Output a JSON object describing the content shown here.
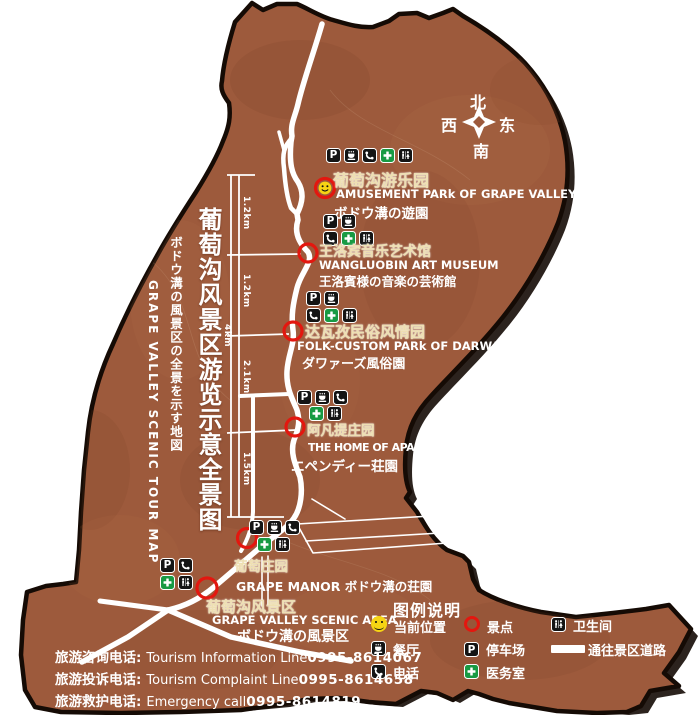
{
  "map_title": {
    "zh": "葡萄沟风景区游览示意全景图",
    "ja": "ボドウ溝の風景区の全景を示す地図",
    "en": "GRAPE  VALLEY  SCENIC  TOUR  MAP"
  },
  "compass": {
    "north": "北",
    "west": "西",
    "east": "东",
    "south": "南"
  },
  "scale": {
    "segments": [
      "1.2km",
      "1.2km",
      "2.1km",
      "1.5km"
    ],
    "total": "4km"
  },
  "icons": {
    "parking_label": "P"
  },
  "pois": [
    {
      "id": "amusement-park",
      "marker": "current-position",
      "icon_rows": [
        [
          "parking",
          "restaurant",
          "phone",
          "medical",
          "toilet"
        ]
      ],
      "zh": "葡萄沟游乐园",
      "en": "AMUSEMENT PARk OF GRAPE VALLEY",
      "ja": "ボドウ溝の遊園"
    },
    {
      "id": "wangluobin-art-museum",
      "marker": "scenic-spot",
      "icon_rows": [
        [
          "parking",
          "restaurant"
        ],
        [
          "phone",
          "medical",
          "toilet"
        ]
      ],
      "zh": "王洛宾音乐艺术馆",
      "en": "WANGLUOBIN ART MUSEUM",
      "ja": "王洛賓様の音楽の芸術館"
    },
    {
      "id": "darwaz-folk-custom-park",
      "marker": "scenic-spot",
      "icon_rows": [
        [
          "parking",
          "restaurant"
        ],
        [
          "phone",
          "medical",
          "toilet"
        ]
      ],
      "zh": "达瓦孜民俗风情园",
      "en": "FOLK-CUSTOM PARk OF DARWAZ",
      "ja": "ダワァーズ風俗園"
    },
    {
      "id": "home-of-apandi",
      "marker": "scenic-spot",
      "icon_rows": [
        [
          "parking",
          "restaurant",
          "phone"
        ],
        [
          "medical",
          "toilet"
        ]
      ],
      "zh": "阿凡提庄园",
      "en": "THE HOME OF APANDI",
      "ja": "エペンディー荘園"
    },
    {
      "id": "grape-manor",
      "marker": "scenic-spot",
      "icon_rows": [
        [
          "parking",
          "restaurant",
          "phone"
        ],
        [
          "medical",
          "toilet"
        ]
      ],
      "zh": "葡萄庄园",
      "en": "GRAPE MANOR ボドウ溝の荘園",
      "ja": ""
    },
    {
      "id": "grape-valley-scenic-area",
      "marker": "scenic-spot",
      "icon_rows": [
        [
          "parking",
          "phone"
        ],
        [
          "medical",
          "toilet"
        ]
      ],
      "zh": "葡萄沟风景区",
      "en": "GRAPE VALLEY SCENIC AREA",
      "ja": "ボドウ溝の風景区"
    }
  ],
  "legend": {
    "title": "图例说明",
    "items": [
      {
        "icon": "current-position",
        "label": "当前位置"
      },
      {
        "icon": "scenic-spot",
        "label": "景点"
      },
      {
        "icon": "toilet",
        "label": "卫生间"
      },
      {
        "icon": "restaurant",
        "label": "餐厅"
      },
      {
        "icon": "parking",
        "label": "停车场"
      },
      {
        "icon": "road",
        "label": "通往景区道路"
      },
      {
        "icon": "phone",
        "label": "电话"
      },
      {
        "icon": "medical",
        "label": "医务室"
      }
    ]
  },
  "hotlines": [
    {
      "zh": "旅游咨询电话:",
      "en": "Tourism Information Line",
      "number": "0995-8614067"
    },
    {
      "zh": "旅游投诉电话:",
      "en": "Tourism  Complaint  Line",
      "number": "0995-8614658"
    },
    {
      "zh": "旅游救护电话:",
      "en": "Emergency  call",
      "number": "0995-8614819"
    }
  ],
  "colors": {
    "map_fill": "#9d5a3c",
    "border": "#150b05",
    "road": "#ffffff",
    "marker_red": "#e3170f",
    "medical_green": "#189a43",
    "smiley_yellow": "#f6d414"
  }
}
